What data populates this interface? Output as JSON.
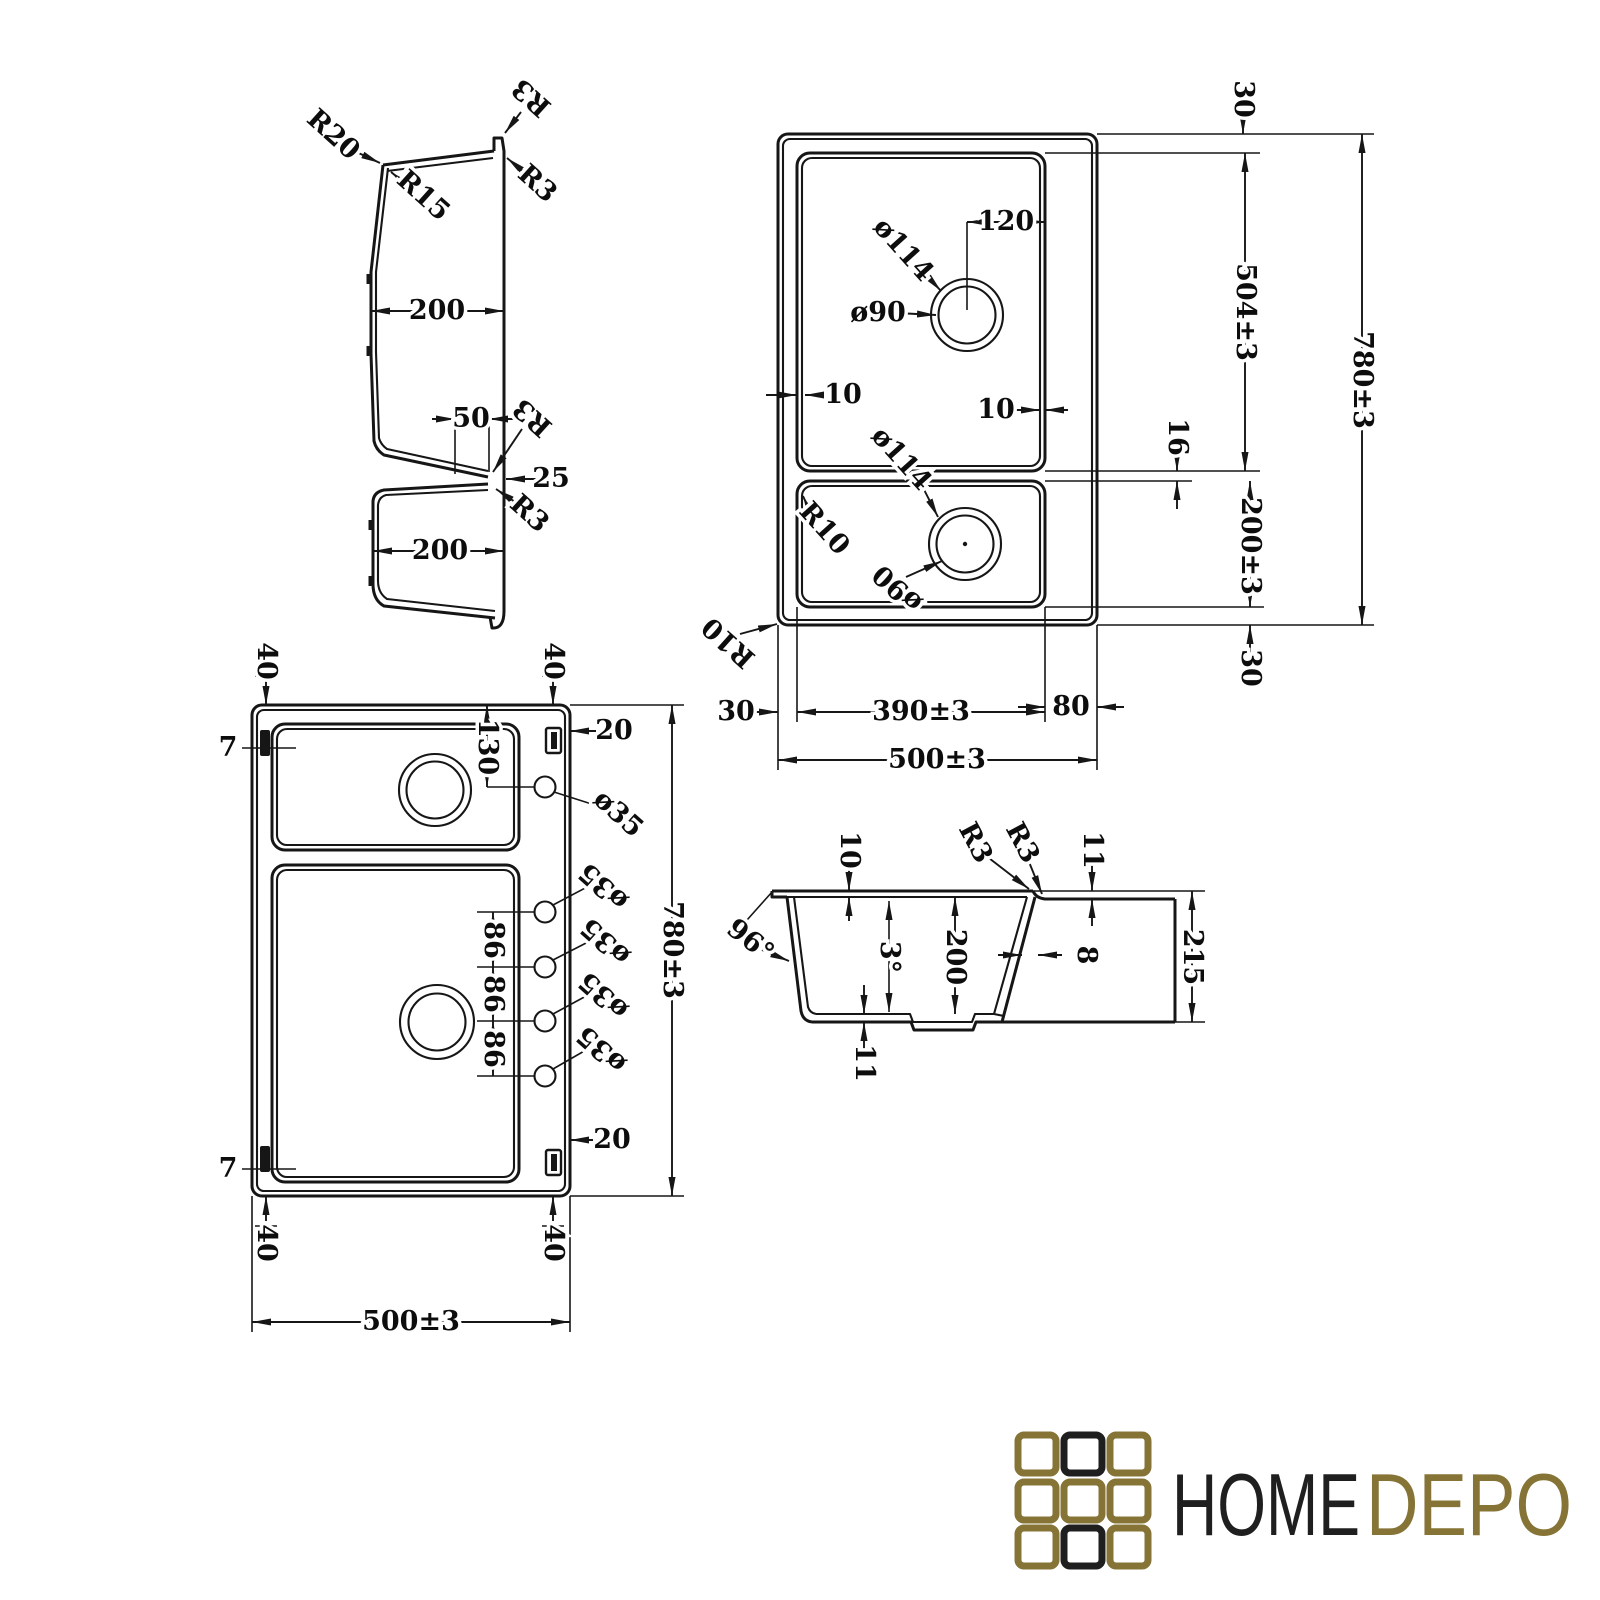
{
  "colors": {
    "ink": "#161616",
    "background": "#ffffff",
    "gold": "#867437",
    "logo_dark": "#1f1f1f"
  },
  "brand": {
    "home": "HOME",
    "depo": "DEPO"
  },
  "profile_view": {
    "r20": "R20",
    "r15": "R15",
    "r3_top": "R3",
    "r3_upper": "R3",
    "width_top_bowl": "200",
    "divider_width": "50",
    "r3_mid": "R3",
    "divider_gap": "25",
    "r3_lower": "R3",
    "width_bottom_bowl": "200"
  },
  "plan_view": {
    "margin_top": "30",
    "drain_offset": "120",
    "drain_outer_top": "ø114",
    "drain_inner_top": "ø90",
    "bowl_main_length": "504±3",
    "overall_length": "780±3",
    "lip_left": "10",
    "lip_right": "10",
    "divider": "16",
    "drain_outer_bottom": "ø114",
    "corner_bowl": "R10",
    "drain_inner_bottom": "ø90",
    "bowl_small_length": "200±3",
    "corner_outer": "R10",
    "margin_left": "30",
    "margin_bottom": "30",
    "bowl_width": "390±3",
    "deck_right": "80",
    "overall_width": "500±3"
  },
  "holes_view": {
    "offset_top_left": "40",
    "offset_top_right": "40",
    "clip_top_left": "7",
    "clip_top_right": "20",
    "first_hole_offset": "130",
    "hole_1": "ø35",
    "hole_2": "ø35",
    "hole_3": "ø35",
    "hole_4": "ø35",
    "hole_5": "ø35",
    "pitch_1": "86",
    "pitch_2": "86",
    "pitch_3": "86",
    "overall_length": "780±3",
    "clip_bottom_right": "20",
    "clip_bottom_left": "7",
    "offset_bottom_left": "40",
    "offset_bottom_right": "40",
    "overall_width": "500±3"
  },
  "section_view": {
    "rim_lip": "10",
    "r3_left": "R3",
    "r3_right": "R3",
    "rim_step": "11",
    "wall_angle": "96°",
    "taper_angle": "3°",
    "bowl_depth": "200",
    "wall_thickness": "8",
    "overall_depth": "215",
    "base_thickness": "11"
  }
}
